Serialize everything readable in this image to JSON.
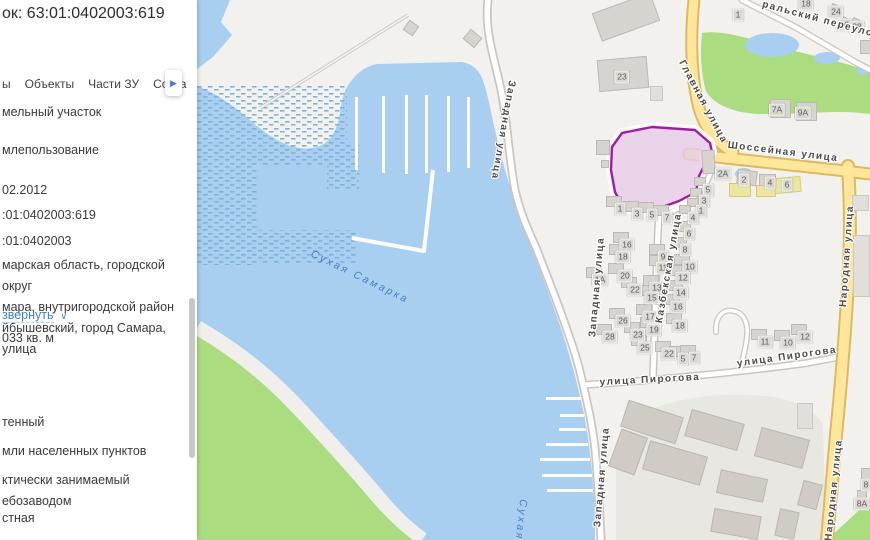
{
  "panel": {
    "title": "ок: 63:01:0402003:619",
    "tabs": [
      {
        "label": "ы"
      },
      {
        "label": "Объекты"
      },
      {
        "label": "Части ЗУ"
      },
      {
        "label": "Соста"
      }
    ],
    "more_icon": "▶",
    "rows": [
      {
        "y": 102,
        "text": "мельный участок"
      },
      {
        "y": 140,
        "text": "млепользование"
      },
      {
        "y": 180,
        "text": "02.2012"
      },
      {
        "y": 205,
        "text": ":01:0402003:619"
      },
      {
        "y": 231,
        "text": ":01:0402003"
      },
      {
        "y": 255,
        "text": "марская область, городской округ\nмара, внутригородской район\nйбышевский, город Самара, улица"
      },
      {
        "y": 328,
        "text": "033 кв. м"
      },
      {
        "y": 412,
        "text": "тенный"
      },
      {
        "y": 441,
        "text": "мли населенных пунктов"
      },
      {
        "y": 470,
        "text": "ктически занимаемый\nебозаводом"
      },
      {
        "y": 508,
        "text": "стная"
      }
    ],
    "expand": {
      "label": "звернуть",
      "icon": "∨",
      "y": 305
    }
  },
  "map": {
    "colors": {
      "water": "#a8cef0",
      "green": "#abdc80",
      "road_yellow": "#ffe69a",
      "road_yellow_border": "#dcba62",
      "parcel_fill": "#e7cce8",
      "parcel_stroke": "#9b1fa0",
      "link_blue": "#3d7edb"
    },
    "parcel": {
      "fill": "#e7cce8",
      "stroke": "#9b1fa0",
      "points": [
        [
          425,
          133
        ],
        [
          455,
          127
        ],
        [
          498,
          130
        ],
        [
          513,
          143
        ],
        [
          515,
          152
        ],
        [
          507,
          153
        ],
        [
          508,
          164
        ],
        [
          502,
          176
        ],
        [
          499,
          192
        ],
        [
          482,
          201
        ],
        [
          457,
          210
        ],
        [
          438,
          211
        ],
        [
          425,
          205
        ],
        [
          418,
          192
        ],
        [
          414,
          170
        ],
        [
          415,
          147
        ]
      ]
    },
    "street_labels": [
      {
        "text": "Западная улица",
        "x": 306,
        "y": 130,
        "rot": 100
      },
      {
        "text": "Западная улица",
        "x": 400,
        "y": 287,
        "rot": -85
      },
      {
        "text": "Западная улица",
        "x": 405,
        "y": 477,
        "rot": -85
      },
      {
        "text": "Казбекская улица",
        "x": 472,
        "y": 268,
        "rot": -80
      },
      {
        "text": "улица Пирогова",
        "x": 453,
        "y": 380,
        "rot": -3
      },
      {
        "text": "улица Пирогова",
        "x": 590,
        "y": 357,
        "rot": -8
      },
      {
        "text": "Шоссейная улица",
        "x": 586,
        "y": 152,
        "rot": 7
      },
      {
        "text": "Главная улица",
        "x": 506,
        "y": 102,
        "rot": 62
      },
      {
        "text": "Народная улица",
        "x": 650,
        "y": 256,
        "rot": -86
      },
      {
        "text": "Народная улица",
        "x": 637,
        "y": 490,
        "rot": -84
      },
      {
        "text": "ральский переулок",
        "x": 624,
        "y": 20,
        "rot": 15
      },
      {
        "text": "Сухая Самарка",
        "x": 163,
        "y": 277,
        "rot": 26,
        "water": true
      },
      {
        "text": "Сухая",
        "x": 324,
        "y": 520,
        "rot": 96,
        "water": true
      }
    ],
    "house_numbers": [
      {
        "n": "1",
        "x": 541,
        "y": 15
      },
      {
        "n": "18",
        "x": 609,
        "y": 4
      },
      {
        "n": "24",
        "x": 639,
        "y": 12
      },
      {
        "n": "26",
        "x": 647,
        "y": 25
      },
      {
        "n": "28",
        "x": 660,
        "y": 27
      },
      {
        "n": "23",
        "x": 425,
        "y": 77
      },
      {
        "n": "7А",
        "x": 580,
        "y": 110
      },
      {
        "n": "9А",
        "x": 606,
        "y": 113
      },
      {
        "n": "2А",
        "x": 526,
        "y": 174
      },
      {
        "n": "2",
        "x": 547,
        "y": 180
      },
      {
        "n": "4",
        "x": 573,
        "y": 183
      },
      {
        "n": "6",
        "x": 590,
        "y": 185
      },
      {
        "n": "5",
        "x": 511,
        "y": 190
      },
      {
        "n": "3",
        "x": 507,
        "y": 201
      },
      {
        "n": "1",
        "x": 504,
        "y": 211
      },
      {
        "n": "4",
        "x": 496,
        "y": 218
      },
      {
        "n": "1",
        "x": 423,
        "y": 209
      },
      {
        "n": "3",
        "x": 440,
        "y": 214
      },
      {
        "n": "5",
        "x": 455,
        "y": 215
      },
      {
        "n": "7",
        "x": 470,
        "y": 218
      },
      {
        "n": "6",
        "x": 492,
        "y": 234
      },
      {
        "n": "8",
        "x": 488,
        "y": 250
      },
      {
        "n": "10",
        "x": 493,
        "y": 267
      },
      {
        "n": "12",
        "x": 486,
        "y": 278
      },
      {
        "n": "14",
        "x": 484,
        "y": 293
      },
      {
        "n": "16",
        "x": 481,
        "y": 307
      },
      {
        "n": "18",
        "x": 483,
        "y": 326
      },
      {
        "n": "16",
        "x": 430,
        "y": 245
      },
      {
        "n": "18",
        "x": 426,
        "y": 257
      },
      {
        "n": "9",
        "x": 466,
        "y": 257
      },
      {
        "n": "11",
        "x": 466,
        "y": 268
      },
      {
        "n": "20",
        "x": 428,
        "y": 276
      },
      {
        "n": "1А",
        "x": 403,
        "y": 280
      },
      {
        "n": "22",
        "x": 438,
        "y": 290
      },
      {
        "n": "13",
        "x": 460,
        "y": 288
      },
      {
        "n": "15",
        "x": 455,
        "y": 298
      },
      {
        "n": "17",
        "x": 453,
        "y": 317
      },
      {
        "n": "26",
        "x": 426,
        "y": 321
      },
      {
        "n": "19",
        "x": 457,
        "y": 330
      },
      {
        "n": "23",
        "x": 441,
        "y": 335
      },
      {
        "n": "28",
        "x": 413,
        "y": 337
      },
      {
        "n": "25",
        "x": 448,
        "y": 348
      },
      {
        "n": "22",
        "x": 472,
        "y": 354
      },
      {
        "n": "5",
        "x": 486,
        "y": 359
      },
      {
        "n": "7",
        "x": 497,
        "y": 358
      },
      {
        "n": "11",
        "x": 568,
        "y": 342
      },
      {
        "n": "10",
        "x": 591,
        "y": 343
      },
      {
        "n": "12",
        "x": 608,
        "y": 337
      },
      {
        "n": "8",
        "x": 669,
        "y": 485
      },
      {
        "n": "8А",
        "x": 665,
        "y": 504
      }
    ],
    "buildings": [
      {
        "x": 398,
        "y": 2,
        "w": 62,
        "h": 30,
        "r": -20,
        "c": "g"
      },
      {
        "x": 401,
        "y": 58,
        "w": 50,
        "h": 32,
        "r": -5,
        "c": "g"
      },
      {
        "x": 453,
        "y": 86,
        "w": 13,
        "h": 15,
        "c": "l"
      },
      {
        "x": 208,
        "y": 22,
        "w": 12,
        "h": 12,
        "r": 35,
        "c": "g"
      },
      {
        "x": 268,
        "y": 32,
        "w": 15,
        "h": 13,
        "r": 40,
        "c": "g"
      },
      {
        "x": 399,
        "y": 140,
        "w": 14,
        "h": 15,
        "c": "g"
      },
      {
        "x": 404,
        "y": 160,
        "w": 8,
        "h": 8,
        "c": "g"
      },
      {
        "x": 505,
        "y": 150,
        "w": 13,
        "h": 24,
        "r": -3,
        "c": "g"
      },
      {
        "x": 573,
        "y": 99,
        "w": 21,
        "h": 19,
        "c": "g"
      },
      {
        "x": 599,
        "y": 102,
        "w": 21,
        "h": 19,
        "c": "g"
      },
      {
        "x": 540,
        "y": 170,
        "w": 20,
        "h": 15,
        "r": 8,
        "c": "g"
      },
      {
        "x": 532,
        "y": 183,
        "w": 22,
        "h": 14,
        "c": "y"
      },
      {
        "x": 562,
        "y": 174,
        "w": 17,
        "h": 12,
        "c": "g"
      },
      {
        "x": 559,
        "y": 185,
        "w": 20,
        "h": 12,
        "c": "y"
      },
      {
        "x": 577,
        "y": 177,
        "w": 27,
        "h": 16,
        "r": -5,
        "c": "y"
      },
      {
        "x": 633,
        "y": 5,
        "w": 12,
        "h": 10,
        "r": 25,
        "c": "g"
      },
      {
        "x": 641,
        "y": 17,
        "w": 12,
        "h": 10,
        "r": 25,
        "c": "g"
      },
      {
        "x": 654,
        "y": 19,
        "w": 12,
        "h": 10,
        "r": 25,
        "c": "g"
      },
      {
        "x": 663,
        "y": 40,
        "w": 12,
        "h": 14,
        "c": "g"
      },
      {
        "x": 655,
        "y": 195,
        "w": 17,
        "h": 16,
        "c": "l"
      },
      {
        "x": 656,
        "y": 235,
        "w": 17,
        "h": 62,
        "c": "l"
      },
      {
        "x": 426,
        "y": 408,
        "w": 58,
        "h": 28,
        "r": 18,
        "c": "i"
      },
      {
        "x": 490,
        "y": 416,
        "w": 55,
        "h": 28,
        "r": 16,
        "c": "i"
      },
      {
        "x": 448,
        "y": 448,
        "w": 60,
        "h": 30,
        "r": 16,
        "c": "i"
      },
      {
        "x": 560,
        "y": 433,
        "w": 50,
        "h": 30,
        "r": 15,
        "c": "i"
      },
      {
        "x": 521,
        "y": 474,
        "w": 48,
        "h": 24,
        "r": 12,
        "c": "i"
      },
      {
        "x": 603,
        "y": 482,
        "w": 20,
        "h": 26,
        "r": 15,
        "c": "i"
      },
      {
        "x": 515,
        "y": 512,
        "w": 48,
        "h": 24,
        "r": 10,
        "c": "i"
      },
      {
        "x": 580,
        "y": 510,
        "w": 20,
        "h": 28,
        "r": 12,
        "c": "i"
      },
      {
        "x": 417,
        "y": 432,
        "w": 28,
        "h": 40,
        "r": 20,
        "c": "i"
      },
      {
        "x": 600,
        "y": 403,
        "w": 16,
        "h": 26,
        "c": "l"
      },
      {
        "x": 664,
        "y": 468,
        "w": 10,
        "h": 12,
        "c": "g"
      },
      {
        "x": 660,
        "y": 490,
        "w": 10,
        "h": 10,
        "c": "g"
      },
      {
        "x": 416,
        "y": 232
      },
      {
        "x": 412,
        "y": 244
      },
      {
        "x": 452,
        "y": 244
      },
      {
        "x": 452,
        "y": 255
      },
      {
        "x": 411,
        "y": 263
      },
      {
        "x": 424,
        "y": 277
      },
      {
        "x": 446,
        "y": 275
      },
      {
        "x": 441,
        "y": 285
      },
      {
        "x": 439,
        "y": 304
      },
      {
        "x": 412,
        "y": 308
      },
      {
        "x": 443,
        "y": 317
      },
      {
        "x": 427,
        "y": 322
      },
      {
        "x": 399,
        "y": 324
      },
      {
        "x": 434,
        "y": 335
      },
      {
        "x": 458,
        "y": 341
      },
      {
        "x": 472,
        "y": 346
      },
      {
        "x": 483,
        "y": 345
      },
      {
        "x": 389,
        "y": 267
      },
      {
        "x": 478,
        "y": 221
      },
      {
        "x": 474,
        "y": 237
      },
      {
        "x": 477,
        "y": 254
      },
      {
        "x": 472,
        "y": 265
      },
      {
        "x": 470,
        "y": 280
      },
      {
        "x": 467,
        "y": 294
      },
      {
        "x": 469,
        "y": 313
      },
      {
        "x": 409,
        "y": 196
      },
      {
        "x": 426,
        "y": 201
      },
      {
        "x": 441,
        "y": 202
      },
      {
        "x": 456,
        "y": 205
      },
      {
        "x": 497,
        "y": 177,
        "w": 12,
        "h": 9
      },
      {
        "x": 493,
        "y": 188,
        "w": 12,
        "h": 9
      },
      {
        "x": 490,
        "y": 198,
        "w": 12,
        "h": 9
      },
      {
        "x": 482,
        "y": 205,
        "w": 12,
        "h": 9
      },
      {
        "x": 554,
        "y": 329
      },
      {
        "x": 577,
        "y": 330
      },
      {
        "x": 594,
        "y": 324
      },
      {
        "x": 458,
        "y": 285,
        "w": 12,
        "h": 20
      }
    ],
    "piers_vertical": [
      {
        "x": 158,
        "y1": 97,
        "y2": 170
      },
      {
        "x": 185,
        "y1": 96,
        "y2": 173
      },
      {
        "x": 208,
        "y1": 95,
        "y2": 174
      },
      {
        "x": 228,
        "y1": 95,
        "y2": 173
      },
      {
        "x": 250,
        "y1": 96,
        "y2": 172
      },
      {
        "x": 270,
        "y1": 97,
        "y2": 168
      }
    ],
    "piers_horizontal": [
      {
        "y": 397,
        "x1": 349,
        "x2": 384
      },
      {
        "y": 414,
        "x1": 363,
        "x2": 387
      },
      {
        "y": 428,
        "x1": 362,
        "x2": 389
      },
      {
        "y": 443,
        "x1": 349,
        "x2": 391
      },
      {
        "y": 458,
        "x1": 343,
        "x2": 393
      },
      {
        "y": 474,
        "x1": 345,
        "x2": 395
      },
      {
        "y": 489,
        "x1": 350,
        "x2": 396
      }
    ]
  }
}
